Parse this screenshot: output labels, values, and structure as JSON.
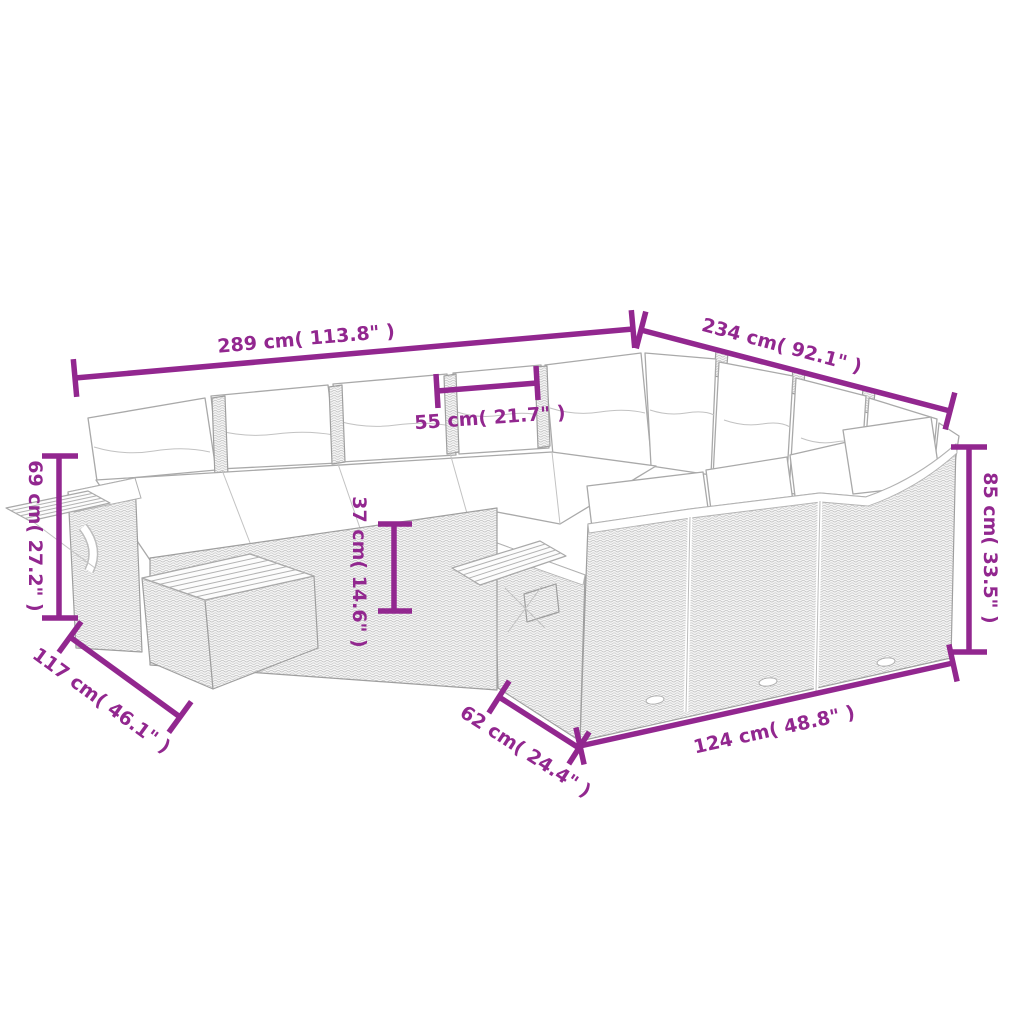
{
  "image": {
    "type": "product dimension diagram",
    "subject": "modular rattan garden sofa set line drawing with cushions, ottoman and slatted side trays",
    "accent_color": "#92278F",
    "sketch_color": "#A9A9A9"
  },
  "dimensions": [
    {
      "id": "overall-width",
      "label": "289 cm( 113.8\" )"
    },
    {
      "id": "overall-depth",
      "label": "234 cm( 92.1\" )"
    },
    {
      "id": "seat-width",
      "label": "55 cm( 21.7\" )"
    },
    {
      "id": "arm-height",
      "label": "69 cm( 27.2\" )"
    },
    {
      "id": "seat-height",
      "label": "37 cm( 14.6\" )"
    },
    {
      "id": "back-height",
      "label": "85 cm( 33.5\" )"
    },
    {
      "id": "side-depth",
      "label": "117 cm( 46.1\" )"
    },
    {
      "id": "module-depth",
      "label": "62 cm( 24.4\" )"
    },
    {
      "id": "right-width",
      "label": "124 cm( 48.8\" )"
    }
  ]
}
